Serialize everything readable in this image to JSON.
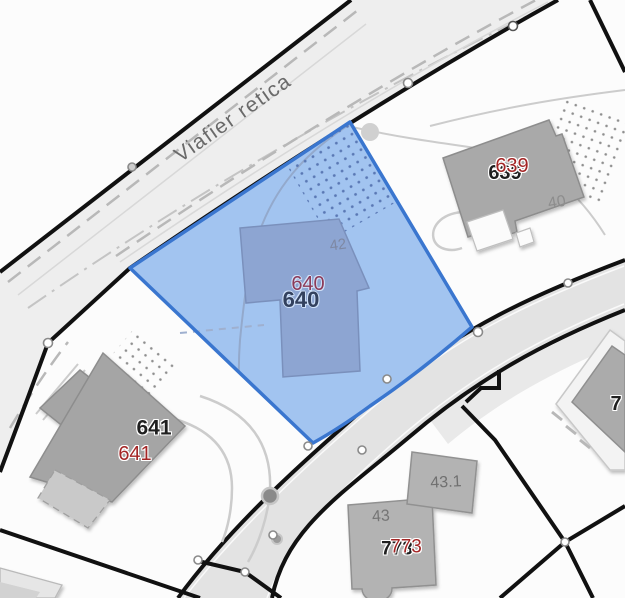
{
  "map": {
    "street_label": "Viafier retica",
    "selected_parcel_number": "640",
    "parcel_numbers": [
      "640",
      "639",
      "641",
      "773"
    ],
    "partial_parcel_number": "7",
    "building_numbers": [
      "40",
      "42",
      "43",
      "43.1"
    ],
    "colors": {
      "selection_fill": "#a2c4f0",
      "selection_border": "#3a76cf",
      "selected_building_fill": "#8da5d2",
      "building_gray": "#ababab",
      "road_fill": "#e3e3e3",
      "railway_fill": "#eeeeee",
      "boundary_black": "#111111",
      "parcel_label_red": "#a32525",
      "parcel_label_black": "#1f1f1f"
    },
    "labels": [
      {
        "name": "street-label",
        "text": "Viafier retica"
      },
      {
        "name": "parcel-640-red",
        "text": "640"
      },
      {
        "name": "parcel-640-bold",
        "text": "640"
      },
      {
        "name": "parcel-639-bold",
        "text": "639"
      },
      {
        "name": "parcel-639-red",
        "text": "639"
      },
      {
        "name": "parcel-641-bold",
        "text": "641"
      },
      {
        "name": "parcel-641-red",
        "text": "641"
      },
      {
        "name": "parcel-773-bold",
        "text": "773"
      },
      {
        "name": "parcel-773-red",
        "text": "773"
      },
      {
        "name": "parcel-7xx-partial",
        "text": "7"
      },
      {
        "name": "building-40",
        "text": "40"
      },
      {
        "name": "building-42",
        "text": "42"
      },
      {
        "name": "building-43",
        "text": "43"
      },
      {
        "name": "building-43-1",
        "text": "43.1"
      }
    ]
  }
}
